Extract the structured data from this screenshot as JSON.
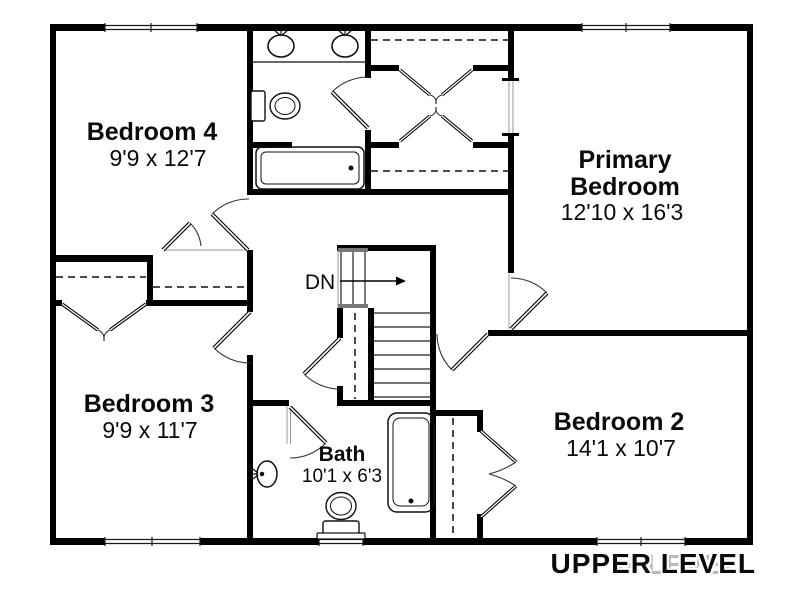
{
  "title": "Upper level floor plan",
  "footer": {
    "level_label": "UPPER LEVEL",
    "ghost_label": "R LEVEL"
  },
  "rooms": {
    "bedroom4": {
      "name": "Bedroom 4",
      "dims": "9'9 x 12'7"
    },
    "primary": {
      "name_line1": "Primary",
      "name_line2": "Bedroom",
      "dims": "12'10 x 16'3"
    },
    "bedroom3": {
      "name": "Bedroom 3",
      "dims": "9'9 x 11'7"
    },
    "bedroom2": {
      "name": "Bedroom 2",
      "dims": "14'1 x 10'7"
    },
    "bath": {
      "name": "Bath",
      "dims": "10'1 x 6'3"
    }
  },
  "stairs": {
    "direction_label": "DN"
  },
  "fixtures": [
    "double-vanity-sinks",
    "toilet",
    "bathtub",
    "pedestal-sink",
    "toilet",
    "bathtub"
  ],
  "colors": {
    "wall": "#000000",
    "thin_line": "#444444",
    "light_line": "#999999",
    "railing_cap": "#777777",
    "ghost_text": "#b9b9b9",
    "background": "#ffffff"
  }
}
